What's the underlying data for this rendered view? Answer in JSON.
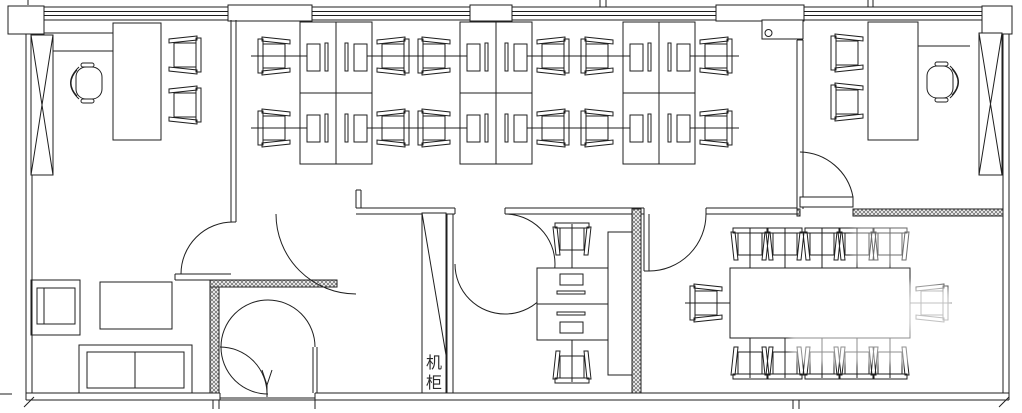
{
  "page": {
    "type": "CAD office floor plan drawing",
    "background": "#ffffff",
    "line_color": "#1f1f1f",
    "wall_hatch_color": "#777777"
  },
  "labels": {
    "server_cabinet": "机柜",
    "server_cabinet_chars": [
      "机",
      "柜"
    ]
  },
  "rooms": [
    {
      "id": "executive-office-left",
      "furniture": "desk, executive chair, 2 guest chairs, credenza lines, window column with X brace"
    },
    {
      "id": "open-office",
      "furniture": "3 clusters of 4 workstations: 12 desks with monitors and keyboards, 12 task chairs"
    },
    {
      "id": "executive-office-right",
      "furniture": "desk, executive chair, 2 guest chairs, wall shelf with cup, window column with X brace"
    },
    {
      "id": "lounge-reception",
      "furniture": "sofa, armchair, coffee table, double entry door"
    },
    {
      "id": "server-equipment-room",
      "furniture": "tall server cabinet labeled 机柜, 2 face-to-face desks with monitors, 2 chairs, side counter"
    },
    {
      "id": "conference-room",
      "furniture": "large conference table with 12 chairs (5 top, 5 bottom, 1 each end)"
    }
  ],
  "watermark": {
    "present": true,
    "description": "faded semi-transparent white stamp over conference table area"
  }
}
